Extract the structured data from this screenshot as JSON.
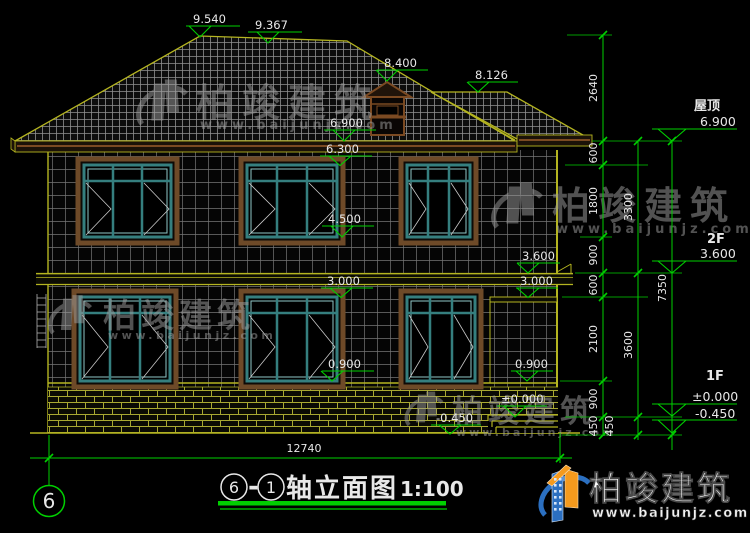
{
  "drawing": {
    "title": {
      "axis_from": "6",
      "separator": "-",
      "axis_to": "1",
      "text": "轴立面图",
      "scale": "1:100"
    },
    "axis_bubble_label": "6",
    "levels": {
      "ridge_main": "9.540",
      "ridge_break": "9.367",
      "dormer_top": "8.400",
      "wing_ridge": "8.126",
      "eave": "6.900",
      "win2f_top": "6.300",
      "win2f_sill": "4.500",
      "band_left": "3.000",
      "sill1f_left": "0.900",
      "porch_roof": "3.600",
      "band_right": "3.000",
      "sill1f_right": "0.900",
      "porch_floor": "±0.000",
      "ground_right": "-0.450"
    },
    "right_levels": {
      "roof_label": "屋顶",
      "roof_value": "6.900",
      "f2_label": "2F",
      "f2_value": "3.600",
      "f1_label": "1F",
      "f1_value": "±0.000",
      "ground_value": "-0.450"
    },
    "dims": {
      "total_width": "12740",
      "col1": [
        "2640",
        "600",
        "1800",
        "900",
        "600",
        "2100",
        "900",
        "450"
      ],
      "col2": [
        "3300",
        "3600",
        "450"
      ],
      "col3": [
        "7350"
      ]
    }
  },
  "brand": {
    "name": "柏竣建筑",
    "url": "www.baijunjz.com"
  }
}
